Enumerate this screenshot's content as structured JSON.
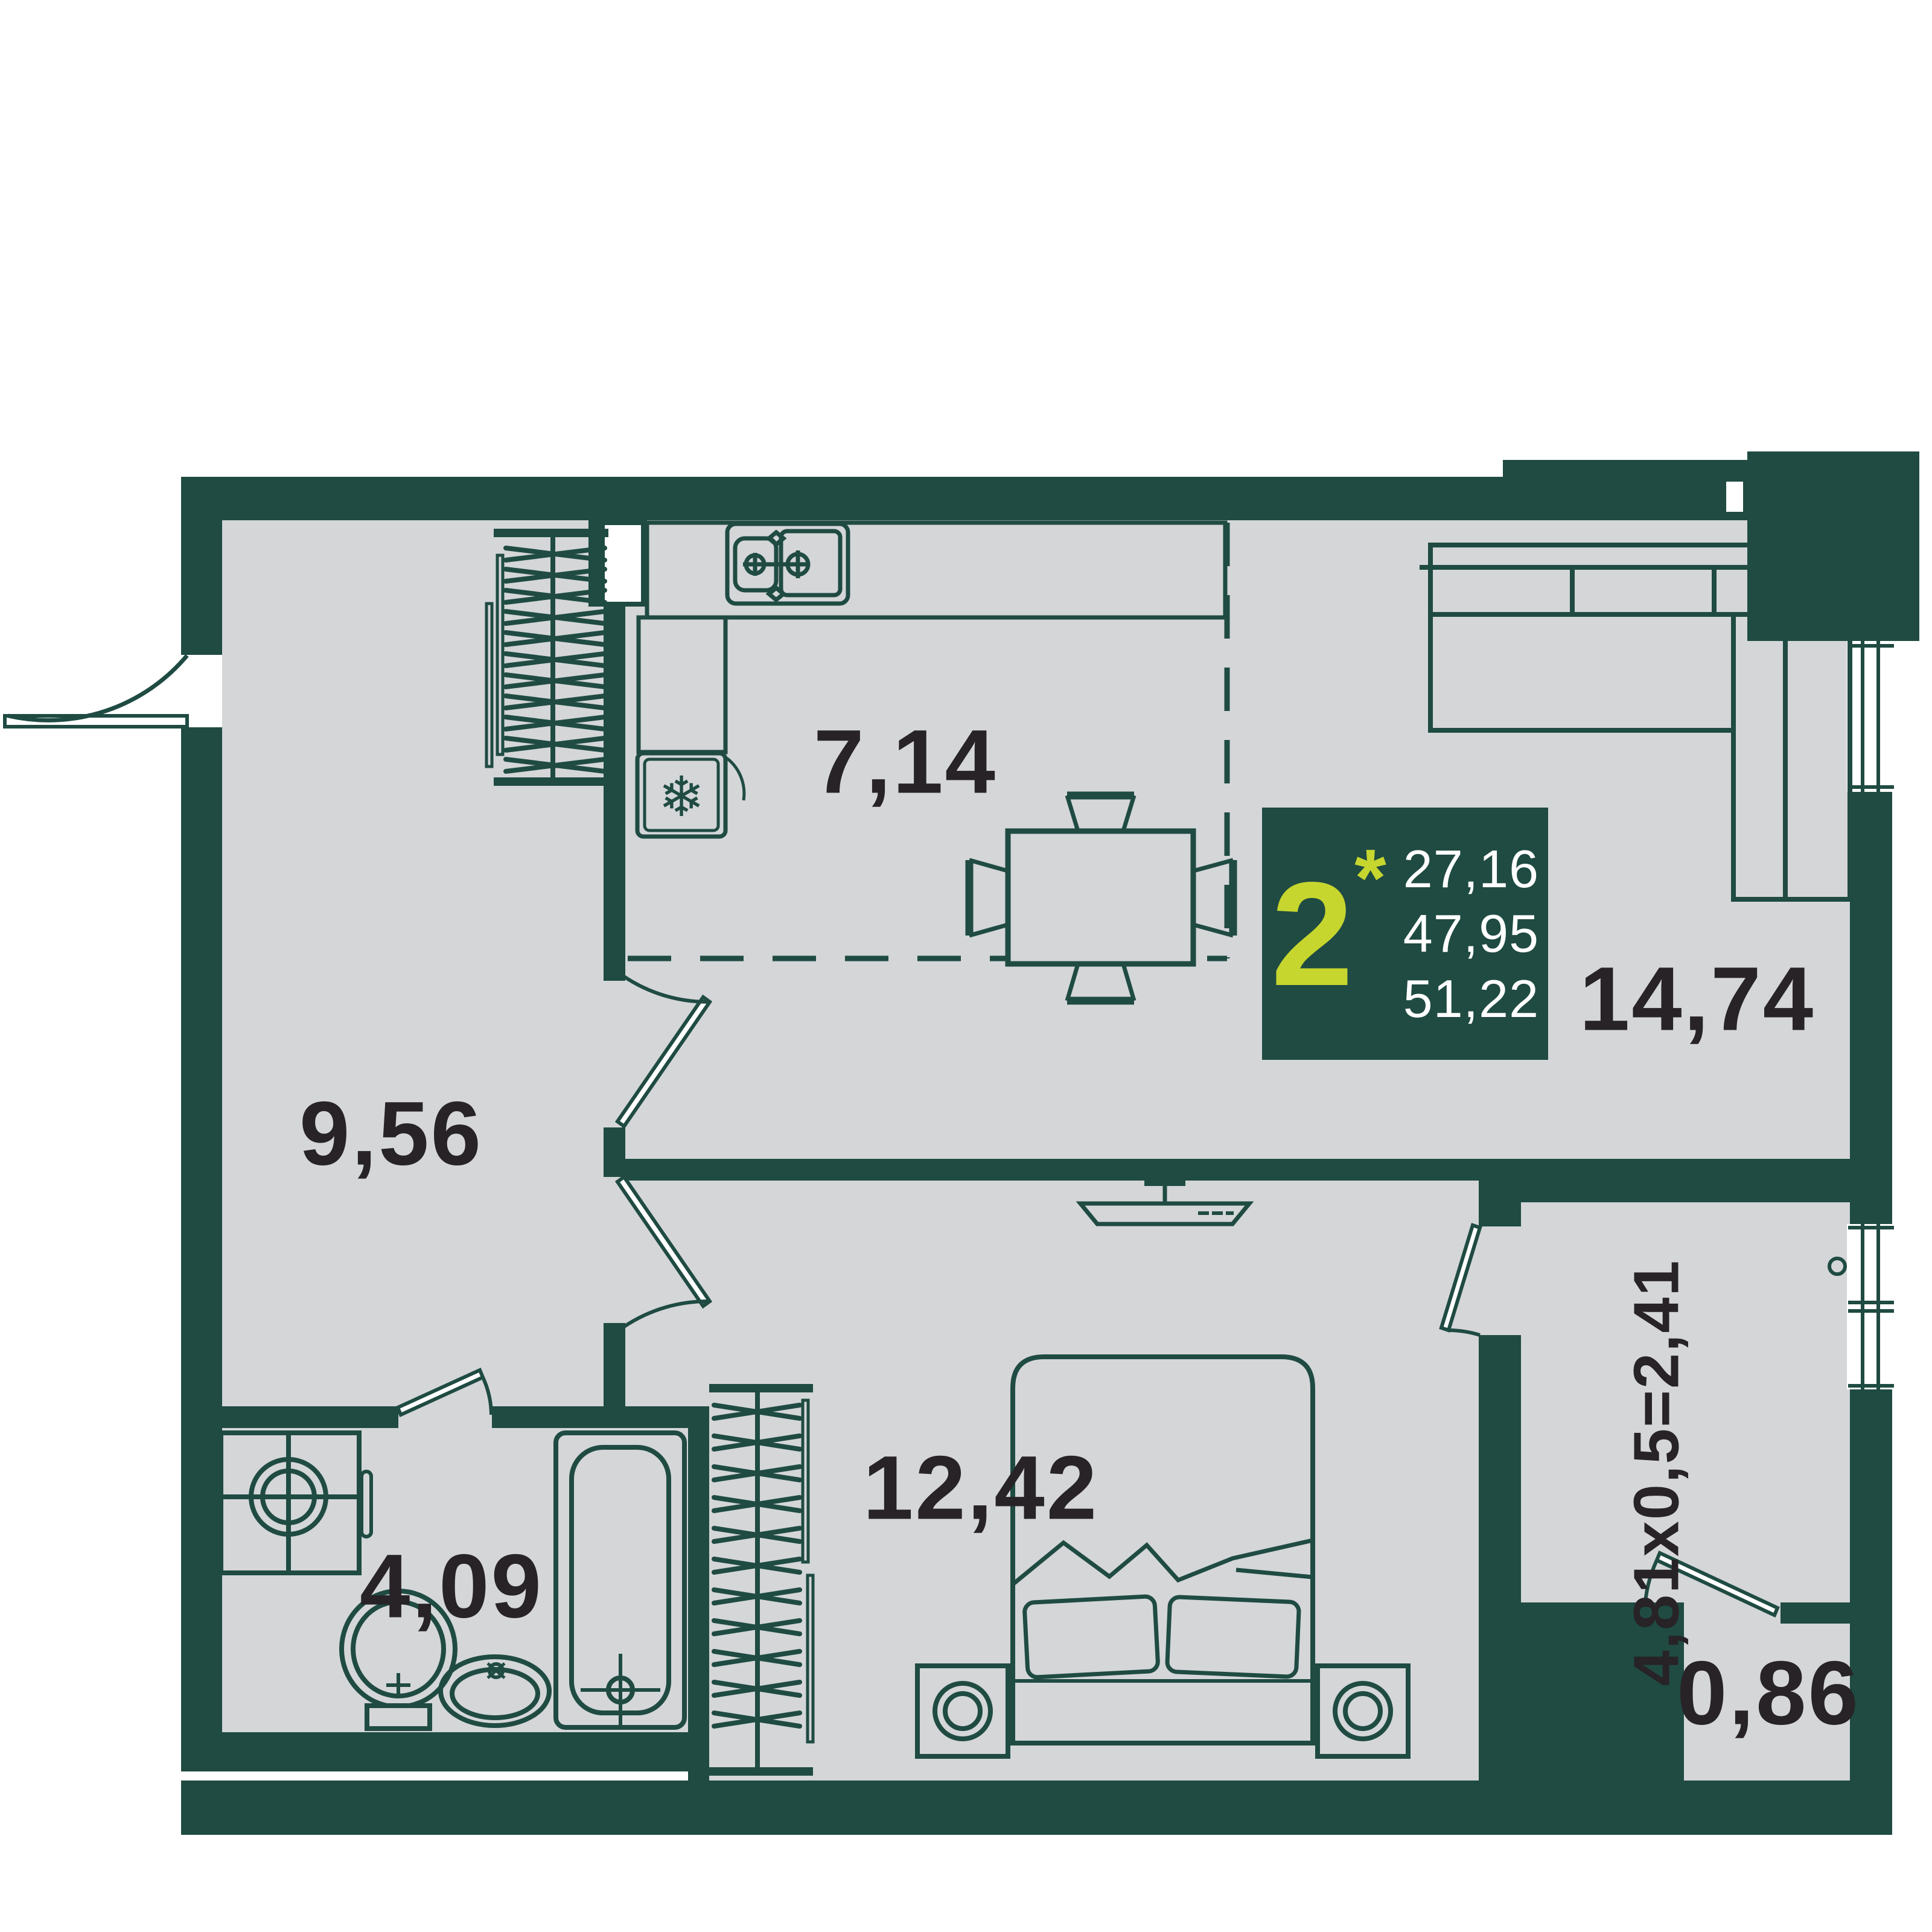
{
  "info": {
    "rooms_count": "2",
    "star": "*",
    "values": [
      "27,16",
      "47,95",
      "51,22"
    ]
  },
  "rooms": {
    "kitchen": {
      "area": "7,14"
    },
    "hallway": {
      "area": "9,56"
    },
    "living": {
      "area": "14,74"
    },
    "bedroom": {
      "area": "12,42"
    },
    "bathroom": {
      "area": "4,09"
    },
    "storage": {
      "area": "0,86"
    },
    "balcony": {
      "area": "4,81x0,5=2,41"
    }
  },
  "icons": {
    "snowflake": "❄"
  },
  "colors": {
    "wall": "#1f4b42",
    "floor": "#d4d6d8",
    "accent": "#c6d62e",
    "label_text": "#272327",
    "info_text": "#ffffff"
  }
}
